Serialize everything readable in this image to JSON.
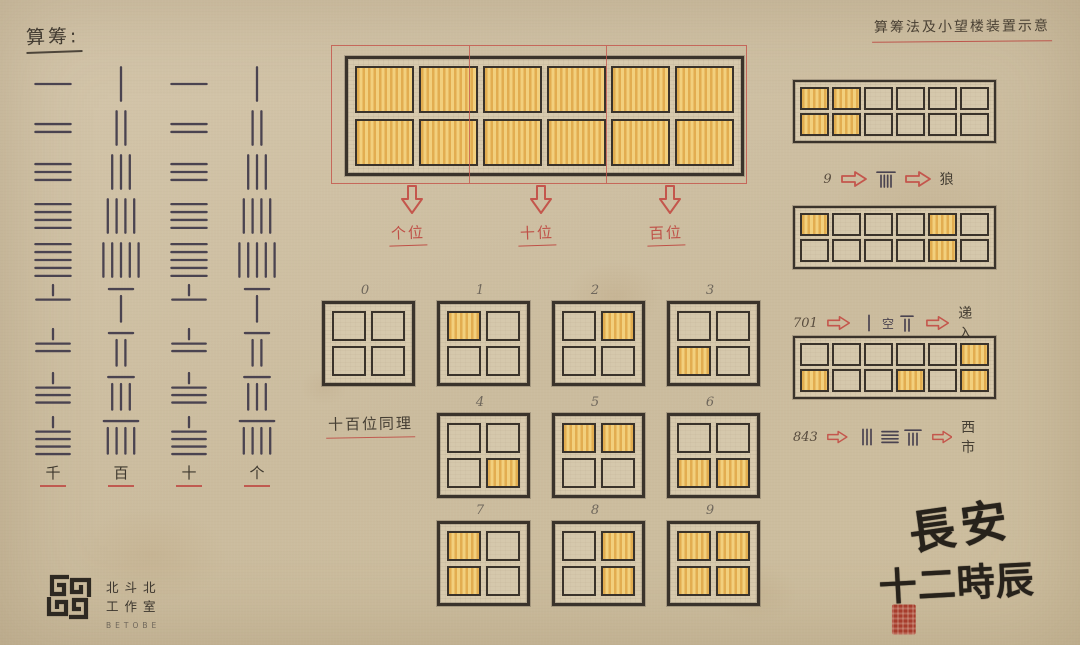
{
  "titles": {
    "left": "算筹:",
    "right": "算筹法及小望楼装置示意"
  },
  "rod_table": {
    "values": [
      1,
      2,
      3,
      4,
      5,
      6,
      7,
      8,
      9
    ],
    "columns": [
      {
        "label": "千",
        "orientation": "horizontal"
      },
      {
        "label": "百",
        "orientation": "vertical"
      },
      {
        "label": "十",
        "orientation": "horizontal"
      },
      {
        "label": "个",
        "orientation": "vertical"
      }
    ]
  },
  "tower_window": {
    "rows": 2,
    "cols": 6,
    "lit": [
      [
        0,
        0
      ],
      [
        0,
        1
      ],
      [
        0,
        2
      ],
      [
        0,
        3
      ],
      [
        0,
        4
      ],
      [
        0,
        5
      ],
      [
        1,
        0
      ],
      [
        1,
        1
      ],
      [
        1,
        2
      ],
      [
        1,
        3
      ],
      [
        1,
        4
      ],
      [
        1,
        5
      ]
    ],
    "sections": [
      "个位",
      "十位",
      "百位"
    ]
  },
  "digit_grids": [
    {
      "digit": "0",
      "rows": 2,
      "cols": 2,
      "lit": []
    },
    {
      "digit": "1",
      "rows": 2,
      "cols": 2,
      "lit": [
        [
          0,
          0
        ]
      ]
    },
    {
      "digit": "2",
      "rows": 2,
      "cols": 2,
      "lit": [
        [
          0,
          1
        ]
      ]
    },
    {
      "digit": "3",
      "rows": 2,
      "cols": 2,
      "lit": [
        [
          1,
          0
        ]
      ]
    },
    {
      "digit": "4",
      "rows": 2,
      "cols": 2,
      "lit": [
        [
          1,
          1
        ]
      ]
    },
    {
      "digit": "5",
      "rows": 2,
      "cols": 2,
      "lit": [
        [
          0,
          0
        ],
        [
          0,
          1
        ]
      ]
    },
    {
      "digit": "6",
      "rows": 2,
      "cols": 2,
      "lit": [
        [
          1,
          0
        ],
        [
          1,
          1
        ]
      ]
    },
    {
      "digit": "7",
      "rows": 2,
      "cols": 2,
      "lit": [
        [
          0,
          0
        ],
        [
          1,
          0
        ]
      ]
    },
    {
      "digit": "8",
      "rows": 2,
      "cols": 2,
      "lit": [
        [
          0,
          1
        ],
        [
          1,
          1
        ]
      ]
    },
    {
      "digit": "9",
      "rows": 2,
      "cols": 2,
      "lit": [
        [
          0,
          0
        ],
        [
          0,
          1
        ],
        [
          1,
          0
        ],
        [
          1,
          1
        ]
      ]
    }
  ],
  "note_same_principle": "十百位同理",
  "examples": [
    {
      "number": "9",
      "rows": 2,
      "cols": 6,
      "lit": [
        [
          0,
          0
        ],
        [
          0,
          1
        ],
        [
          1,
          0
        ],
        [
          1,
          1
        ]
      ],
      "rods": [
        {
          "value": 9,
          "orientation": "vertical"
        }
      ],
      "meaning": "狼"
    },
    {
      "number": "701",
      "rows": 2,
      "cols": 6,
      "lit": [
        [
          0,
          0
        ],
        [
          0,
          4
        ],
        [
          1,
          4
        ]
      ],
      "rods": [
        {
          "value": 1,
          "orientation": "vertical"
        },
        {
          "text": "空"
        },
        {
          "value": 7,
          "orientation": "vertical"
        }
      ],
      "meaning": "递入"
    },
    {
      "number": "843",
      "rows": 2,
      "cols": 6,
      "lit": [
        [
          1,
          0
        ],
        [
          1,
          3
        ],
        [
          0,
          5
        ],
        [
          1,
          5
        ]
      ],
      "rods": [
        {
          "value": 3,
          "orientation": "vertical"
        },
        {
          "value": 4,
          "orientation": "horizontal"
        },
        {
          "value": 8,
          "orientation": "vertical"
        }
      ],
      "meaning": "西市"
    }
  ],
  "footer": {
    "studio_line1": "北斗北",
    "studio_line2": "工作室",
    "studio_latin": "BETOBE",
    "calligraphy_line1": "長安",
    "calligraphy_line2": "十二時辰"
  },
  "colors": {
    "paper": "#cfc1a5",
    "ink": "#3a332b",
    "rod_ink": "#4a4350",
    "accent_red": "#bf5047",
    "panel_yellow": "#f2d07d",
    "panel_stripe": "#e2ad50",
    "seal_red": "#a63d2d"
  }
}
